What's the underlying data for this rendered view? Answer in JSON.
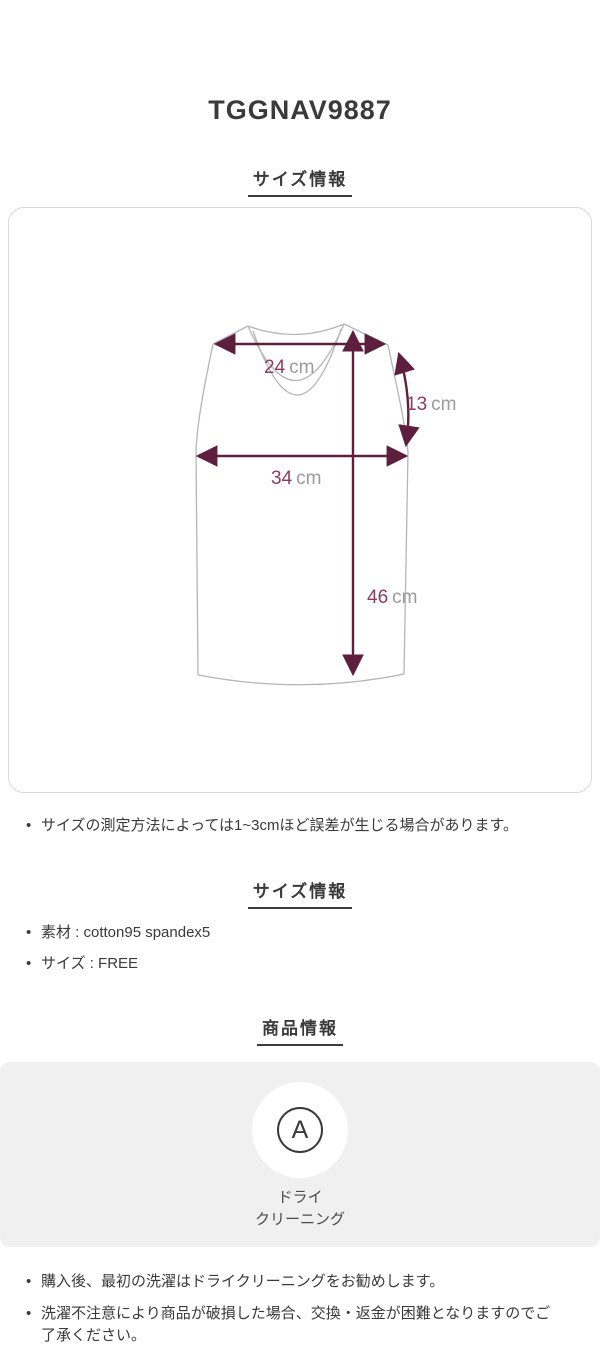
{
  "page": {
    "title": "TGGNAV9887"
  },
  "size_section": {
    "heading": "サイズ情報",
    "measurements": [
      {
        "name": "shoulder-width",
        "value": "24",
        "unit": "cm"
      },
      {
        "name": "armhole-depth",
        "value": "13",
        "unit": "cm"
      },
      {
        "name": "chest-width",
        "value": "34",
        "unit": "cm"
      },
      {
        "name": "total-length",
        "value": "46",
        "unit": "cm"
      }
    ],
    "note": "サイズの測定方法によっては1~3cmほど誤差が生じる場合があります。"
  },
  "spec_section": {
    "heading": "サイズ情報",
    "items": [
      "素材 : cotton95 spandex5",
      "サイズ : FREE"
    ]
  },
  "product_section": {
    "heading": "商品情報",
    "care_symbol": "A",
    "care_label_line1": "ドライ",
    "care_label_line2": "クリーニング",
    "notes": [
      "購入後、最初の洗濯はドライクリーニングをお勧めします。",
      "洗濯不注意により商品が破損した場合、交換・返金が困難となりますのでご了承ください。"
    ]
  },
  "colors": {
    "measure_line": "#5e1f3f",
    "measure_value_text": "#8d3c5f",
    "unit_text": "#9b9b9b",
    "garment_outline": "#b5b5b5",
    "card_border": "#d9d9d9",
    "panel_background": "#f0f0f0",
    "body_text": "#3a3a3a"
  }
}
